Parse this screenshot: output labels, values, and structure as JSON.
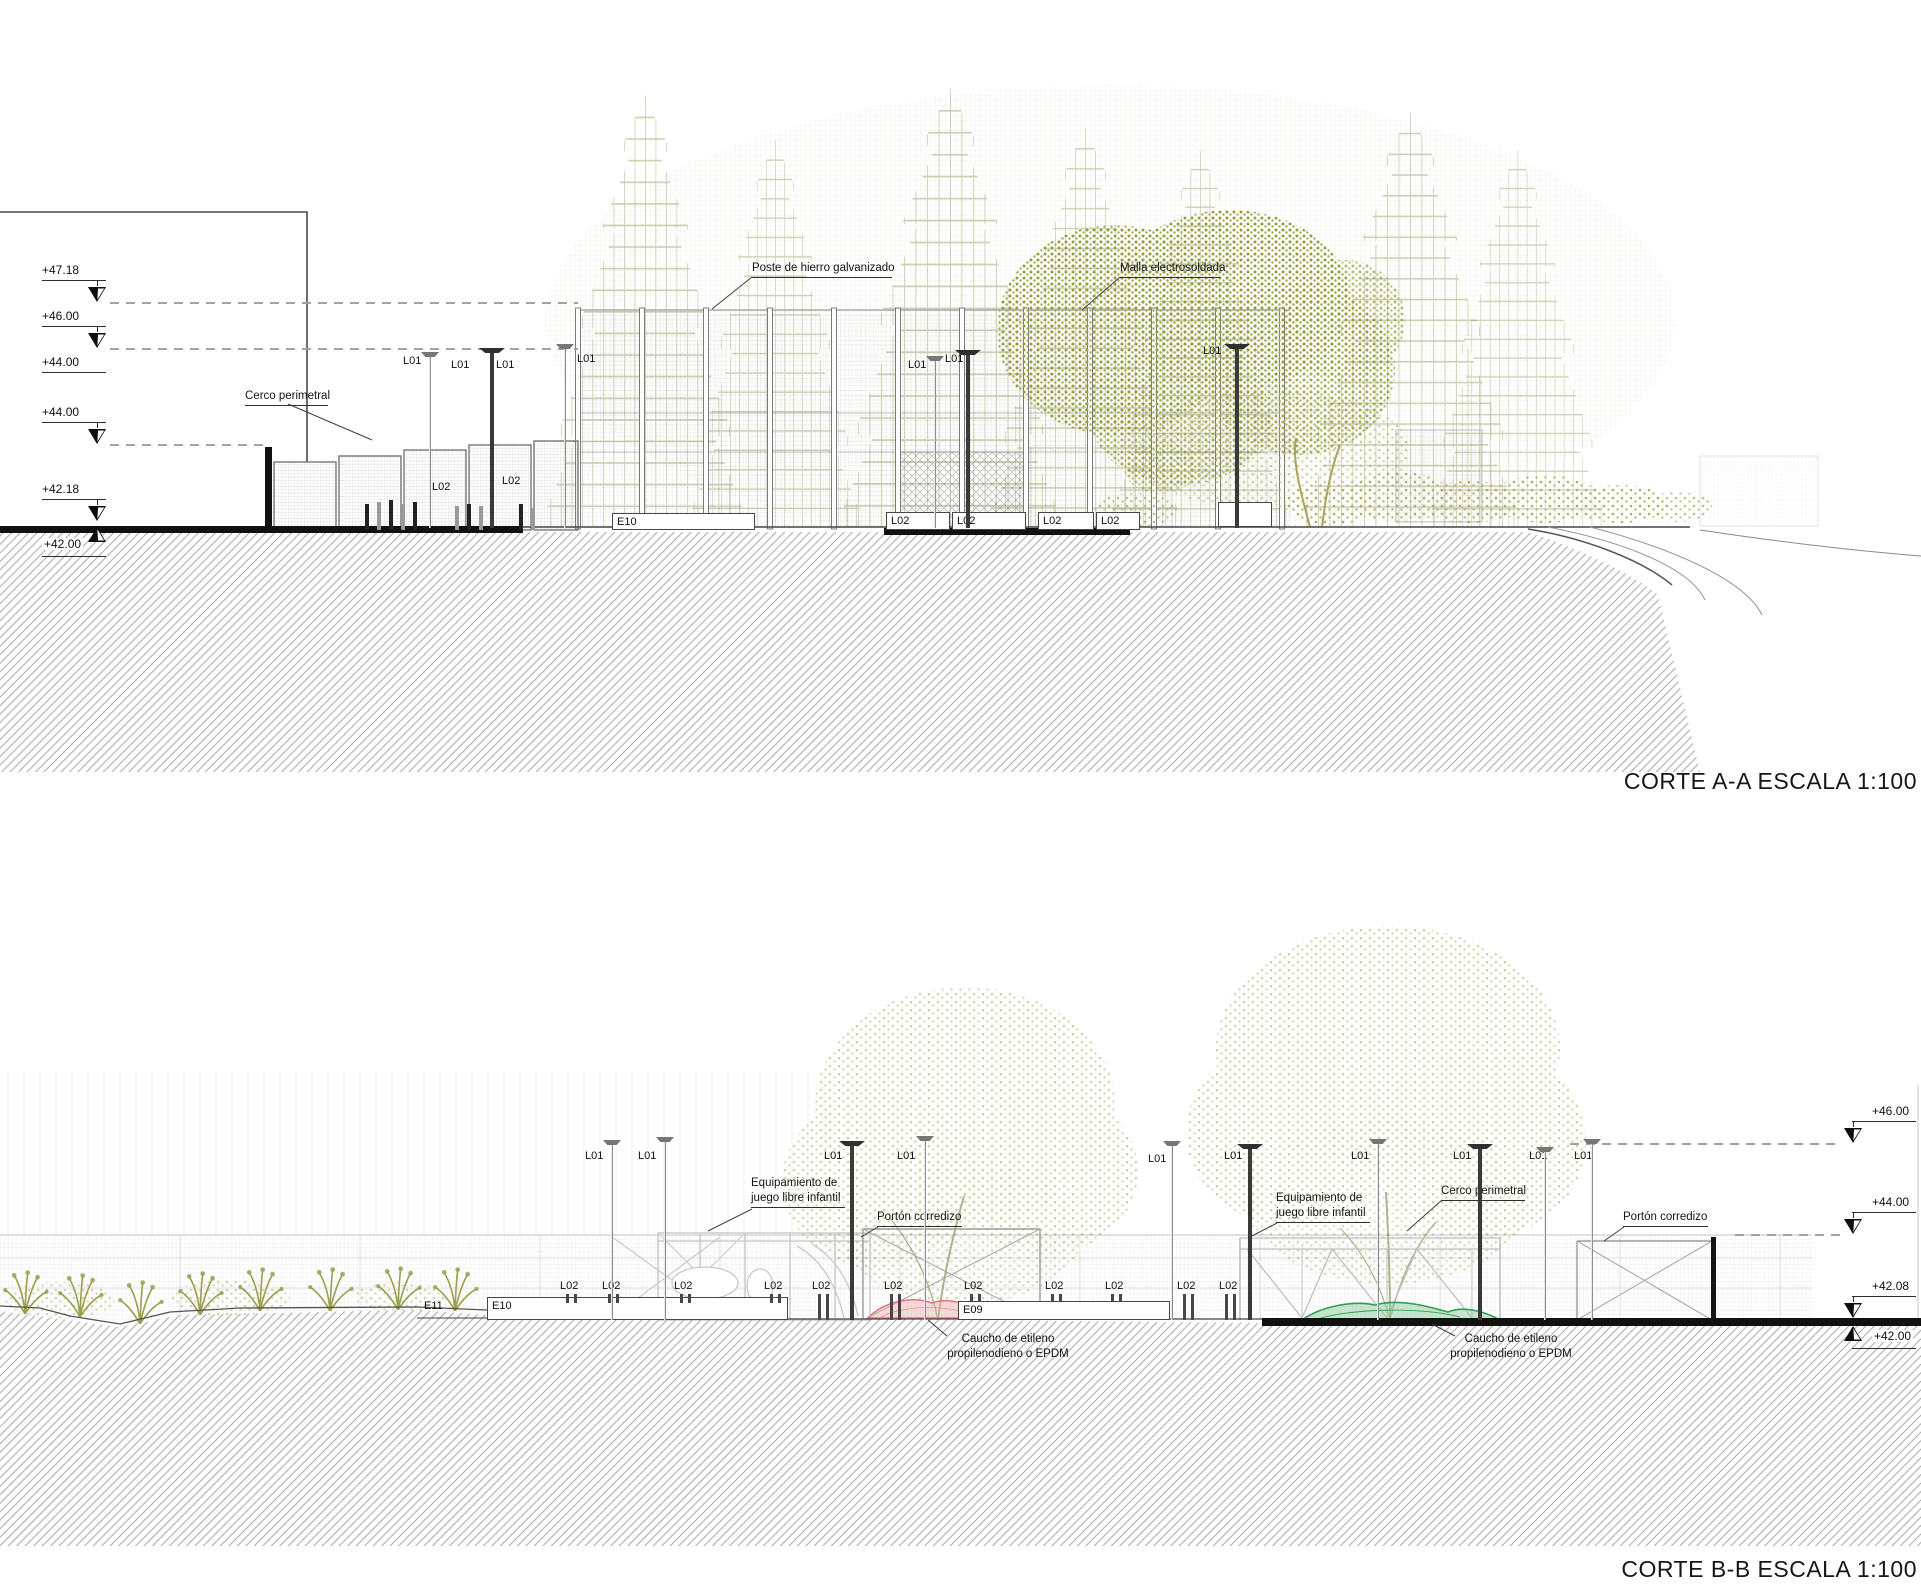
{
  "canvas": {
    "w": 1921,
    "h": 1589
  },
  "titles": {
    "section_a": "CORTE A-A ESCALA 1:100",
    "section_b": "CORTE B-B ESCALA 1:100"
  },
  "colors": {
    "vegetation": "#a6aa5e",
    "vegetation_dark": "#96a03b",
    "epdm_pink": "#dd7777",
    "epdm_green": "#2f9e57",
    "line": "#3a3a3a",
    "hatch": "#adadad"
  },
  "elevation_markers": [
    {
      "section": "a",
      "label": "+47.18",
      "text_y": 264,
      "arrow": "down",
      "dash_to": 578
    },
    {
      "section": "a",
      "label": "+46.00",
      "text_y": 310,
      "arrow": "down",
      "dash_to": 578
    },
    {
      "section": "a",
      "label": "+44.00",
      "text_y": 356,
      "arrow": "none",
      "dash_to": 0
    },
    {
      "section": "a",
      "label": "+44.00",
      "text_y": 406,
      "arrow": "down",
      "dash_to": 268
    },
    {
      "section": "a",
      "label": "+42.18",
      "text_y": 483,
      "arrow": "down",
      "dash_to": 0
    },
    {
      "section": "a",
      "label": "+42.00",
      "text_y": 538,
      "arrow": "up",
      "dash_to": 0
    },
    {
      "section": "b",
      "label": "+46.00",
      "text_y": 1105,
      "arrow": "down",
      "dash_to": 1570
    },
    {
      "section": "b",
      "label": "+44.00",
      "text_y": 1196,
      "arrow": "down",
      "dash_to": 1735
    },
    {
      "section": "b",
      "label": "+42.08",
      "text_y": 1280,
      "arrow": "down",
      "dash_to": 0
    },
    {
      "section": "b",
      "label": "+42.00",
      "text_y": 1330,
      "arrow": "up",
      "dash_to": 0
    }
  ],
  "annotations": [
    {
      "id": "poste",
      "lines": [
        "Poste de hierro galvanizado"
      ],
      "x": 752,
      "y": 261,
      "w": 140,
      "underline": true,
      "align": "left"
    },
    {
      "id": "malla",
      "lines": [
        "Malla electrosoldada"
      ],
      "x": 1120,
      "y": 261,
      "w": 100,
      "underline": true,
      "align": "left"
    },
    {
      "id": "cerco-a",
      "lines": [
        "Cerco perimetral"
      ],
      "x": 245,
      "y": 389,
      "w": 83,
      "underline": true,
      "align": "left"
    },
    {
      "id": "equip-1",
      "lines": [
        "Equipamiento de",
        "juego libre infantil"
      ],
      "x": 751,
      "y": 1176,
      "w": 94,
      "underline": true,
      "align": "left"
    },
    {
      "id": "porton-1",
      "lines": [
        "Portón corredizo"
      ],
      "x": 877,
      "y": 1210,
      "w": 85,
      "underline": true,
      "align": "left"
    },
    {
      "id": "equip-2",
      "lines": [
        "Equipamiento de",
        "juego libre infantil"
      ],
      "x": 1276,
      "y": 1191,
      "w": 94,
      "underline": true,
      "align": "left"
    },
    {
      "id": "cerco-b",
      "lines": [
        "Cerco perimetral"
      ],
      "x": 1441,
      "y": 1184,
      "w": 84,
      "underline": true,
      "align": "left"
    },
    {
      "id": "porton-2",
      "lines": [
        "Portón corredizo"
      ],
      "x": 1623,
      "y": 1210,
      "w": 85,
      "underline": true,
      "align": "left"
    },
    {
      "id": "caucho-1",
      "lines": [
        "Caucho de etileno",
        "propilenodieno o EPDM"
      ],
      "x": 944,
      "y": 1332,
      "w": 128,
      "underline": false,
      "align": "center"
    },
    {
      "id": "caucho-2",
      "lines": [
        "Caucho de etileno",
        "propilenodieno o EPDM"
      ],
      "x": 1444,
      "y": 1332,
      "w": 134,
      "underline": false,
      "align": "center"
    }
  ],
  "tags": [
    {
      "t": "L01",
      "x": 403,
      "y": 356
    },
    {
      "t": "L01",
      "x": 451,
      "y": 360
    },
    {
      "t": "L01",
      "x": 496,
      "y": 360
    },
    {
      "t": "L01",
      "x": 577,
      "y": 354
    },
    {
      "t": "L01",
      "x": 908,
      "y": 360
    },
    {
      "t": "L01",
      "x": 945,
      "y": 354
    },
    {
      "t": "L01",
      "x": 1203,
      "y": 346
    },
    {
      "t": "L02",
      "x": 432,
      "y": 482
    },
    {
      "t": "L02",
      "x": 502,
      "y": 476
    },
    {
      "t": "L01",
      "x": 585,
      "y": 1151
    },
    {
      "t": "L01",
      "x": 638,
      "y": 1151
    },
    {
      "t": "L01",
      "x": 824,
      "y": 1151
    },
    {
      "t": "L01",
      "x": 897,
      "y": 1151
    },
    {
      "t": "L01",
      "x": 1148,
      "y": 1154
    },
    {
      "t": "L01",
      "x": 1224,
      "y": 1151
    },
    {
      "t": "L01",
      "x": 1351,
      "y": 1151
    },
    {
      "t": "L01",
      "x": 1453,
      "y": 1151
    },
    {
      "t": "L01",
      "x": 1529,
      "y": 1151
    },
    {
      "t": "L01",
      "x": 1574,
      "y": 1151
    },
    {
      "t": "L02",
      "x": 560,
      "y": 1281
    },
    {
      "t": "L02",
      "x": 602,
      "y": 1281
    },
    {
      "t": "L02",
      "x": 674,
      "y": 1281
    },
    {
      "t": "L02",
      "x": 764,
      "y": 1281
    },
    {
      "t": "L02",
      "x": 812,
      "y": 1281
    },
    {
      "t": "L02",
      "x": 884,
      "y": 1281
    },
    {
      "t": "L02",
      "x": 964,
      "y": 1281
    },
    {
      "t": "L02",
      "x": 1045,
      "y": 1281
    },
    {
      "t": "L02",
      "x": 1105,
      "y": 1281
    },
    {
      "t": "L02",
      "x": 1177,
      "y": 1281
    },
    {
      "t": "L02",
      "x": 1219,
      "y": 1281
    },
    {
      "t": "E11",
      "x": 424,
      "y": 1301
    }
  ],
  "boxes": [
    {
      "label": "E10",
      "x": 612,
      "y": 513,
      "w": 143,
      "h": 17
    },
    {
      "label": "L02",
      "x": 886,
      "y": 512,
      "w": 64,
      "h": 18
    },
    {
      "label": "L02",
      "x": 952,
      "y": 512,
      "w": 74,
      "h": 18
    },
    {
      "label": "L02",
      "x": 1038,
      "y": 512,
      "w": 56,
      "h": 18
    },
    {
      "label": "L02",
      "x": 1096,
      "y": 512,
      "w": 44,
      "h": 18
    },
    {
      "label": "",
      "x": 1218,
      "y": 502,
      "w": 54,
      "h": 25
    },
    {
      "label": "E10",
      "x": 487,
      "y": 1297,
      "w": 301,
      "h": 23
    },
    {
      "label": "E09",
      "x": 958,
      "y": 1301,
      "w": 212,
      "h": 19
    }
  ],
  "poles": [
    {
      "x": 430,
      "top": 352,
      "bot": 528,
      "s": "l"
    },
    {
      "x": 492,
      "top": 348,
      "bot": 528,
      "s": "d"
    },
    {
      "x": 565,
      "top": 344,
      "bot": 528,
      "s": "l"
    },
    {
      "x": 935,
      "top": 356,
      "bot": 528,
      "s": "l"
    },
    {
      "x": 968,
      "top": 350,
      "bot": 528,
      "s": "d"
    },
    {
      "x": 1237,
      "top": 344,
      "bot": 528,
      "s": "d"
    },
    {
      "x": 612,
      "top": 1140,
      "bot": 1320,
      "s": "l"
    },
    {
      "x": 665,
      "top": 1137,
      "bot": 1320,
      "s": "l"
    },
    {
      "x": 852,
      "top": 1141,
      "bot": 1320,
      "s": "d"
    },
    {
      "x": 925,
      "top": 1136,
      "bot": 1320,
      "s": "l"
    },
    {
      "x": 1172,
      "top": 1141,
      "bot": 1320,
      "s": "l"
    },
    {
      "x": 1250,
      "top": 1144,
      "bot": 1320,
      "s": "d"
    },
    {
      "x": 1378,
      "top": 1139,
      "bot": 1320,
      "s": "l"
    },
    {
      "x": 1480,
      "top": 1144,
      "bot": 1320,
      "s": "d"
    },
    {
      "x": 1545,
      "top": 1147,
      "bot": 1320,
      "s": "l"
    },
    {
      "x": 1592,
      "top": 1139,
      "bot": 1320,
      "s": "l"
    }
  ],
  "bollards": [
    {
      "x": 365,
      "h": 26,
      "dark": true
    },
    {
      "x": 377,
      "h": 28,
      "dark": false
    },
    {
      "x": 389,
      "h": 30,
      "dark": true
    },
    {
      "x": 401,
      "h": 26,
      "dark": false
    },
    {
      "x": 413,
      "h": 28,
      "dark": true
    },
    {
      "x": 455,
      "h": 24,
      "dark": false
    },
    {
      "x": 467,
      "h": 26,
      "dark": true
    },
    {
      "x": 479,
      "h": 24,
      "dark": false
    },
    {
      "x": 519,
      "h": 26,
      "dark": true
    },
    {
      "x": 531,
      "h": 22,
      "dark": false
    }
  ],
  "l02_posts": [
    {
      "x": 566,
      "h": 9
    },
    {
      "x": 608,
      "h": 9
    },
    {
      "x": 680,
      "h": 9
    },
    {
      "x": 770,
      "h": 9
    },
    {
      "x": 818,
      "h": 26
    },
    {
      "x": 890,
      "h": 26
    },
    {
      "x": 970,
      "h": 8
    },
    {
      "x": 1051,
      "h": 8
    },
    {
      "x": 1111,
      "h": 8
    },
    {
      "x": 1183,
      "h": 26
    },
    {
      "x": 1225,
      "h": 26
    }
  ]
}
